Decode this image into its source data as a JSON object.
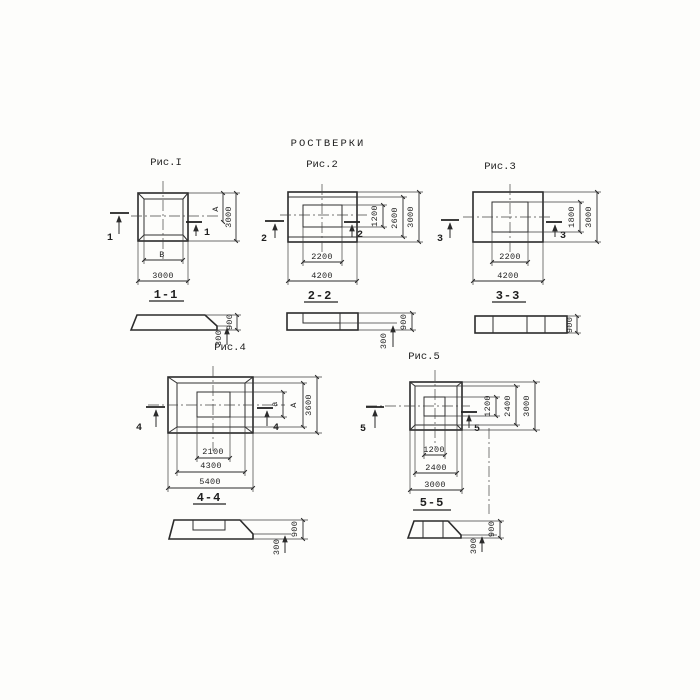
{
  "title": "РОСТВЕРКИ",
  "colors": {
    "ink": "#2b2b2b",
    "paper": "#fdfdfb"
  },
  "figures": {
    "fig1": {
      "label": "Рис.I",
      "plan": {
        "dim_bottom_inner": "В",
        "dim_bottom_outer": "3000",
        "dim_right_inner": "А",
        "dim_right_outer": "3000",
        "cut_mark": "1"
      },
      "section": {
        "label": "1-1",
        "dim_step": "300",
        "dim_total": "900"
      }
    },
    "fig2": {
      "label": "Рис.2",
      "plan": {
        "dim_bottom_inner": "2200",
        "dim_bottom_outer": "4200",
        "dim_right_inner": "1200",
        "dim_right_mid": "2600",
        "dim_right_outer": "3000",
        "cut_mark": "2"
      },
      "section": {
        "label": "2-2",
        "dim_step": "300",
        "dim_total": "900"
      }
    },
    "fig3": {
      "label": "Рис.3",
      "plan": {
        "dim_bottom_inner": "2200",
        "dim_bottom_outer": "4200",
        "dim_right_inner": "1800",
        "dim_right_outer": "3000",
        "cut_mark": "3"
      },
      "section": {
        "label": "3-3",
        "dim_total": "900"
      }
    },
    "fig4": {
      "label": "Рис.4",
      "plan": {
        "dim_bottom_inner": "2100",
        "dim_bottom_mid": "4300",
        "dim_bottom_outer": "5400",
        "dim_right_inner": "а",
        "dim_right_mid": "А",
        "dim_right_outer": "3600",
        "cut_mark": "4"
      },
      "section": {
        "label": "4-4",
        "dim_step": "300",
        "dim_total": "900"
      }
    },
    "fig5": {
      "label": "Рис.5",
      "plan": {
        "dim_bottom_inner": "1200",
        "dim_bottom_mid": "2400",
        "dim_bottom_outer": "3000",
        "dim_right_inner": "1200",
        "dim_right_mid": "2400",
        "dim_right_outer": "3000",
        "cut_mark": "5"
      },
      "section": {
        "label": "5-5",
        "dim_step": "300",
        "dim_total": "900"
      }
    }
  }
}
